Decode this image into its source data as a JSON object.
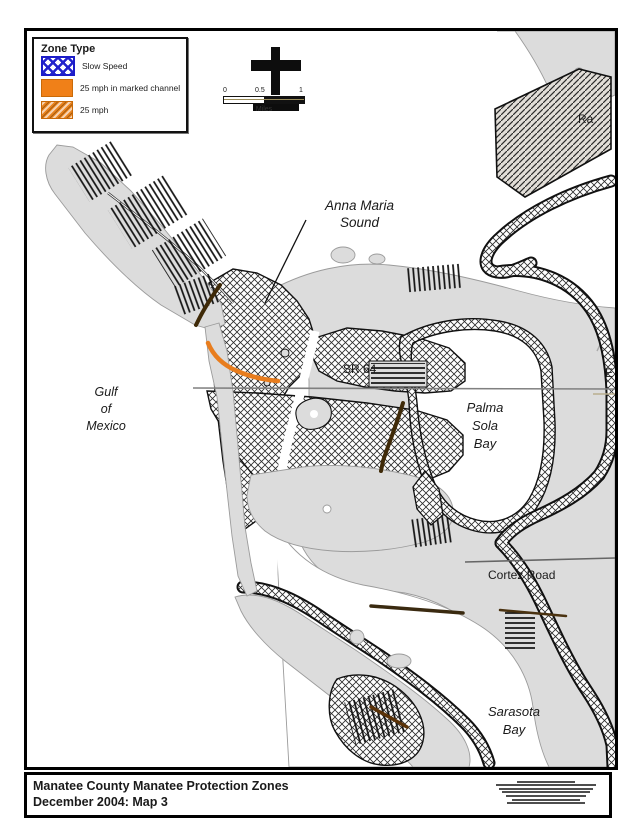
{
  "legend": {
    "title": "Zone Type",
    "items": [
      {
        "label": "Slow Speed",
        "swatch": "blue-crosshatch"
      },
      {
        "label": "25 mph in marked channel",
        "swatch": "orange-solid"
      },
      {
        "label": "25 mph",
        "swatch": "orange-hatch"
      }
    ]
  },
  "scalebar": {
    "ticks": [
      "0",
      "0.5",
      "1"
    ],
    "unit": "Miles"
  },
  "map": {
    "labels": {
      "anna_maria_sound": [
        "Anna Maria",
        "Sound"
      ],
      "gulf_of_mexico": [
        "Gulf",
        "of",
        "Mexico"
      ],
      "sr64": "SR 64",
      "palma_sola_bay": [
        "Palma",
        "Sola",
        "Bay"
      ],
      "cortez_road": "Cortez Road",
      "sarasota_bay": [
        "Sarasota",
        "Bay"
      ],
      "ra_truncated": "Ra",
      "e_truncated": "E"
    }
  },
  "titlebar": {
    "line1": "Manatee County Manatee Protection Zones",
    "line2": "December 2004: Map 3"
  },
  "colors": {
    "slow_speed": "#2323CC",
    "marked_channel": "#F08018",
    "mph25": "#E8821E",
    "land": "#DCDCDC"
  }
}
